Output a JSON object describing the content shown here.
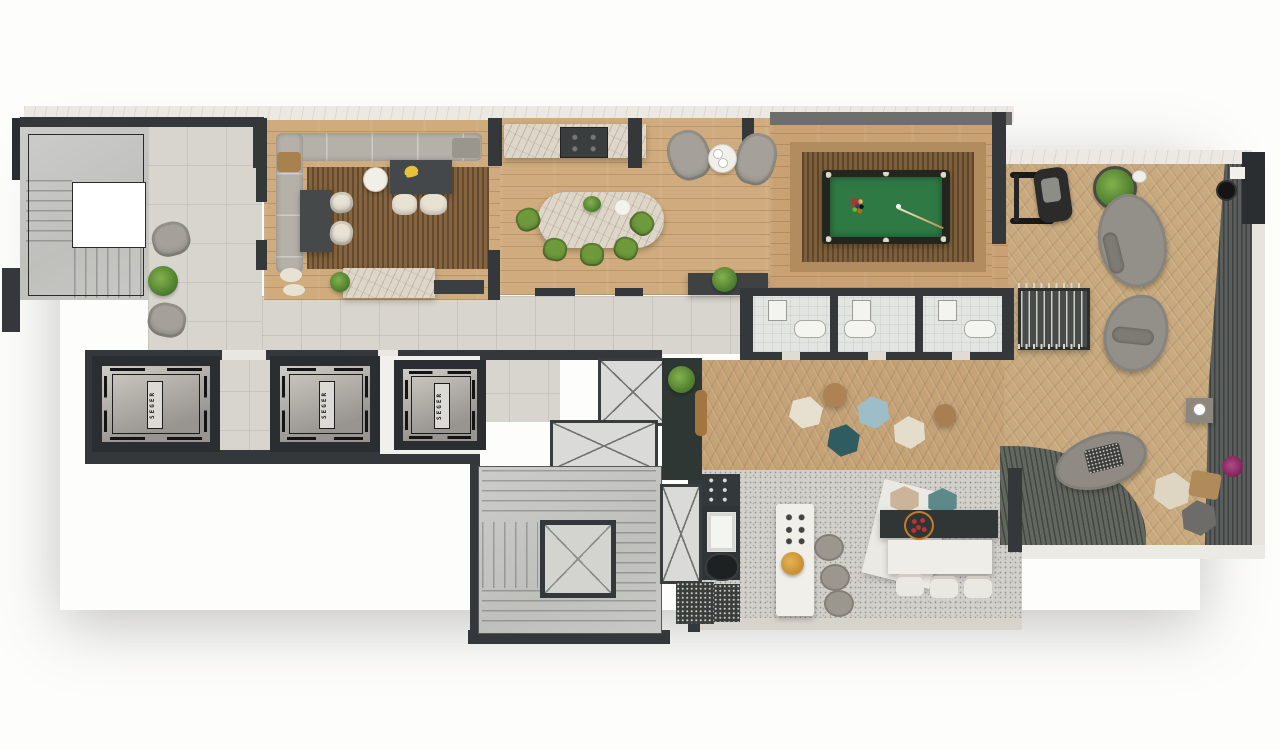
{
  "title": "Amenities floor plan – rendered top view",
  "elevators": {
    "label_1": "SEGER",
    "label_2": "SEGER",
    "label_3": "SEGER"
  },
  "legend": {
    "areas": [
      "staircase",
      "lobby",
      "lounge",
      "dining-gourmet",
      "billiards-room",
      "bathrooms",
      "elevator-hall",
      "service-core",
      "hex-pouf-lounge",
      "terrace-deck",
      "kitchen-barbecue",
      "sun-deck"
    ],
    "furniture": [
      "sofa",
      "armchairs",
      "coffee-table",
      "dining-table",
      "green-chairs",
      "pool-table",
      "hexagonal-poufs",
      "lounge-daybeds",
      "foosball-table",
      "gym-machine",
      "kitchen-island",
      "bar-counter",
      "stools",
      "plants",
      "grill"
    ]
  },
  "colors": {
    "wall": "#35383a",
    "tile_floor": "#d8d5ce",
    "wood_floor": "#cfab7d",
    "terrace_wood": "#c9aa7e",
    "rug_wood": "#7e5f3b",
    "pool_felt": "#2f7a44",
    "terrazzo": "#d2d0cb",
    "dark_deck": "#5a5f5d",
    "chair_green": "#6e9a3c",
    "pouf_blue": "#9dbec8",
    "pouf_teal": "#2f5c60",
    "pouf_cream": "#e7e0d0",
    "pouf_tan": "#ad8255",
    "marble": "#ddd6c9"
  }
}
